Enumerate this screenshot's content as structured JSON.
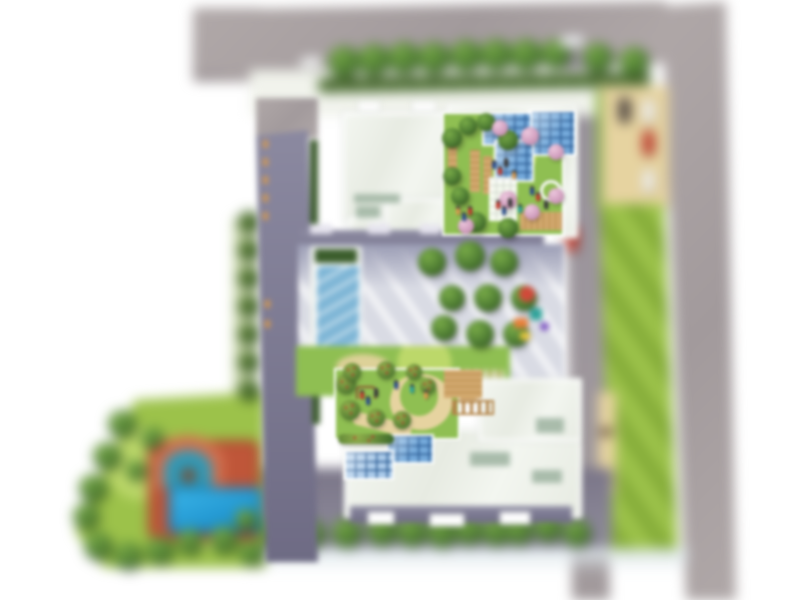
{
  "scene": {
    "type": "residential-complex-site-plan",
    "view": "top-down architectural rendering, tilt-shift blurred",
    "visible_text": "none",
    "canvas": {
      "width": 800,
      "height": 600
    }
  },
  "palette": {
    "road": "#a29a9c",
    "road_hi": "#b0a8a8",
    "road2": "#98929c",
    "roof": "#e7ebe2",
    "roof_hi": "#f3f6f0",
    "roof_patch": "#a9bcab",
    "facade": "#6e6b84",
    "facade_hi": "#8d8ba2",
    "court": "#d9dbe4",
    "court_sh": "#9a9cb4",
    "lawn": "#9cc24a",
    "lawn_stripe": "#86ad3a",
    "lawn_hi": "#bcd86a",
    "garden": "#8fbf52",
    "tree": "#4e7c33",
    "tree_hi": "#79ab48",
    "tree_dk": "#2f4f1e",
    "pink": "#d2a0bf",
    "hedge": "#55763a",
    "hedge_dk": "#496831",
    "sand": "#e6d3a0",
    "wood": "#d2a96e",
    "wood_dk": "#b3854a",
    "terr": "#bf5639",
    "terr_hi": "#d2704e",
    "glass": "#74a9da",
    "glass_light": "#a9c9e8",
    "glass_frame": "#2f5f96",
    "pool": "#1b96d2",
    "pool_dk": "#0e6ca0",
    "people": [
      "#2d4f8f",
      "#c23a2e",
      "#3a3a3a",
      "#d89a4e",
      "#2fa39a"
    ]
  },
  "features": {
    "roads": [
      "north-perimeter-road",
      "east-perimeter-road",
      "inner-east-road"
    ],
    "buildings": [
      "north-wing",
      "west-wing",
      "south-wing"
    ],
    "amenities": [
      "lap-pool",
      "central-courtyard",
      "playground",
      "north-roof-garden",
      "south-roof-garden",
      "leisure-pool",
      "terracotta-pool-deck",
      "surface-parking"
    ]
  },
  "vegetation": {
    "street_trees": {
      "layer": "far",
      "variant": "tree",
      "items": [
        [
          344,
          62,
          16
        ],
        [
          374,
          60,
          16
        ],
        [
          404,
          58,
          16
        ],
        [
          434,
          58,
          16
        ],
        [
          466,
          56,
          16
        ],
        [
          496,
          55,
          16
        ],
        [
          526,
          55,
          16
        ],
        [
          556,
          54,
          15
        ],
        [
          598,
          58,
          15
        ],
        [
          634,
          62,
          15
        ]
      ]
    },
    "west_hedgerow": {
      "layer": "far",
      "variant": "bush",
      "items": [
        [
          249,
          222,
          11
        ],
        [
          249,
          250,
          11
        ],
        [
          249,
          278,
          11
        ],
        [
          249,
          306,
          11
        ],
        [
          249,
          334,
          11
        ],
        [
          249,
          362,
          11
        ],
        [
          249,
          390,
          11
        ]
      ]
    },
    "southwest_boundary_trees": {
      "layer": "far",
      "variant": "tree",
      "items": [
        [
          122,
          424,
          14
        ],
        [
          107,
          456,
          14
        ],
        [
          93,
          488,
          14
        ],
        [
          86,
          516,
          13
        ],
        [
          98,
          546,
          14
        ],
        [
          128,
          556,
          14
        ],
        [
          160,
          550,
          14
        ],
        [
          190,
          542,
          13
        ],
        [
          224,
          540,
          14
        ],
        [
          252,
          552,
          13
        ]
      ]
    },
    "southwest_lawn_trees": {
      "layer": "far",
      "variant": "tree",
      "items": [
        [
          152,
          438,
          11
        ],
        [
          136,
          470,
          10
        ],
        [
          246,
          520,
          11
        ]
      ]
    },
    "south_tree_row": {
      "layer": "far",
      "variant": "tree",
      "items": [
        [
          277,
          532,
          15
        ],
        [
          310,
          534,
          15
        ],
        [
          347,
          533,
          15
        ],
        [
          382,
          531,
          15
        ],
        [
          412,
          532,
          15
        ],
        [
          442,
          533,
          15
        ],
        [
          469,
          531,
          14
        ],
        [
          496,
          532,
          14
        ],
        [
          519,
          531,
          14
        ],
        [
          548,
          528,
          14
        ],
        [
          577,
          533,
          14
        ]
      ]
    },
    "courtyard_trees": {
      "layer": "mid",
      "variant": "tree",
      "items": [
        [
          432,
          262,
          14
        ],
        [
          470,
          256,
          15
        ],
        [
          504,
          262,
          14
        ],
        [
          452,
          298,
          13
        ],
        [
          488,
          298,
          14
        ],
        [
          524,
          298,
          13
        ],
        [
          444,
          328,
          13
        ],
        [
          480,
          334,
          14
        ],
        [
          516,
          334,
          13
        ]
      ]
    },
    "north_garden_trees_green": {
      "layer": "near",
      "variant": "tree",
      "items": [
        [
          452,
          138,
          10
        ],
        [
          468,
          126,
          9
        ],
        [
          486,
          122,
          9
        ],
        [
          508,
          140,
          10
        ],
        [
          452,
          176,
          9
        ],
        [
          460,
          196,
          9
        ],
        [
          476,
          222,
          10
        ],
        [
          508,
          228,
          10
        ]
      ]
    },
    "north_garden_trees_pink": {
      "layer": "near",
      "variant": "pink",
      "items": [
        [
          500,
          128,
          8
        ],
        [
          530,
          136,
          9
        ],
        [
          556,
          152,
          8
        ],
        [
          508,
          200,
          9
        ],
        [
          532,
          212,
          8
        ],
        [
          466,
          226,
          8
        ],
        [
          556,
          196,
          8
        ]
      ]
    },
    "south_garden_trees": {
      "layer": "near",
      "variant": "flower",
      "items": [
        [
          346,
          384,
          10
        ],
        [
          350,
          410,
          10
        ],
        [
          376,
          418,
          9
        ],
        [
          402,
          420,
          9
        ],
        [
          352,
          372,
          9
        ],
        [
          386,
          370,
          9
        ],
        [
          414,
          372,
          8
        ],
        [
          428,
          386,
          8
        ]
      ]
    }
  },
  "vehicles": [
    {
      "name": "car-north-road",
      "color": "#f2f2f2",
      "x": 300,
      "y": 57,
      "w": 22,
      "h": 11,
      "angle": -6
    },
    {
      "name": "car-north-road-2",
      "color": "#eef0f2",
      "x": 560,
      "y": 36,
      "w": 24,
      "h": 11,
      "angle": -4
    },
    {
      "name": "parked-car-dark",
      "color": "#4c4340",
      "x": 619,
      "y": 98,
      "w": 11,
      "h": 24,
      "angle": 0
    },
    {
      "name": "parked-car-white",
      "color": "#f2f2f2",
      "x": 643,
      "y": 100,
      "w": 11,
      "h": 22,
      "angle": 0
    },
    {
      "name": "parked-car-red",
      "color": "#c0392b",
      "x": 643,
      "y": 131,
      "w": 11,
      "h": 24,
      "angle": 0
    },
    {
      "name": "parked-car-white-2",
      "color": "#f2f2f2",
      "x": 643,
      "y": 170,
      "w": 11,
      "h": 22,
      "angle": 0
    },
    {
      "name": "car-inner-road-red",
      "color": "#c0392b",
      "x": 566,
      "y": 227,
      "w": 12,
      "h": 24,
      "angle": 2
    }
  ],
  "people": [
    {
      "layer": "near",
      "group": "north-garden-visitors",
      "items": [
        [
          492,
          160,
          0
        ],
        [
          498,
          166,
          1
        ],
        [
          504,
          158,
          2
        ],
        [
          512,
          170,
          3
        ],
        [
          496,
          200,
          1
        ],
        [
          502,
          206,
          0
        ],
        [
          508,
          198,
          2
        ],
        [
          518,
          204,
          4
        ],
        [
          530,
          186,
          0
        ],
        [
          536,
          192,
          1
        ],
        [
          544,
          200,
          2
        ],
        [
          456,
          206,
          3
        ],
        [
          462,
          212,
          0
        ],
        [
          468,
          206,
          1
        ]
      ]
    },
    {
      "layer": "near",
      "group": "south-garden-visitors",
      "items": [
        [
          360,
          390,
          1
        ],
        [
          366,
          396,
          0
        ],
        [
          374,
          388,
          2
        ],
        [
          394,
          380,
          0
        ],
        [
          410,
          384,
          4
        ],
        [
          424,
          390,
          3
        ]
      ]
    }
  ],
  "playground_items": [
    {
      "name": "umbrella",
      "x": 519,
      "y": 286,
      "w": 16,
      "h": 16,
      "color": "#d04a3a",
      "round": true
    },
    {
      "name": "slide",
      "x": 514,
      "y": 318,
      "w": 14,
      "h": 10,
      "color": "#e8803a",
      "round": false
    },
    {
      "name": "climber",
      "x": 530,
      "y": 308,
      "w": 12,
      "h": 12,
      "color": "#2fa39a",
      "round": false
    },
    {
      "name": "springer",
      "x": 520,
      "y": 332,
      "w": 10,
      "h": 8,
      "color": "#e8c63f",
      "round": false
    },
    {
      "name": "play-toy",
      "x": 540,
      "y": 322,
      "w": 9,
      "h": 9,
      "color": "#7e57c2",
      "round": true
    }
  ],
  "facade_windows": [
    [
      263,
      140
    ],
    [
      263,
      158
    ],
    [
      263,
      176
    ],
    [
      263,
      194
    ],
    [
      263,
      212
    ],
    [
      265,
      300
    ],
    [
      265,
      320
    ]
  ]
}
